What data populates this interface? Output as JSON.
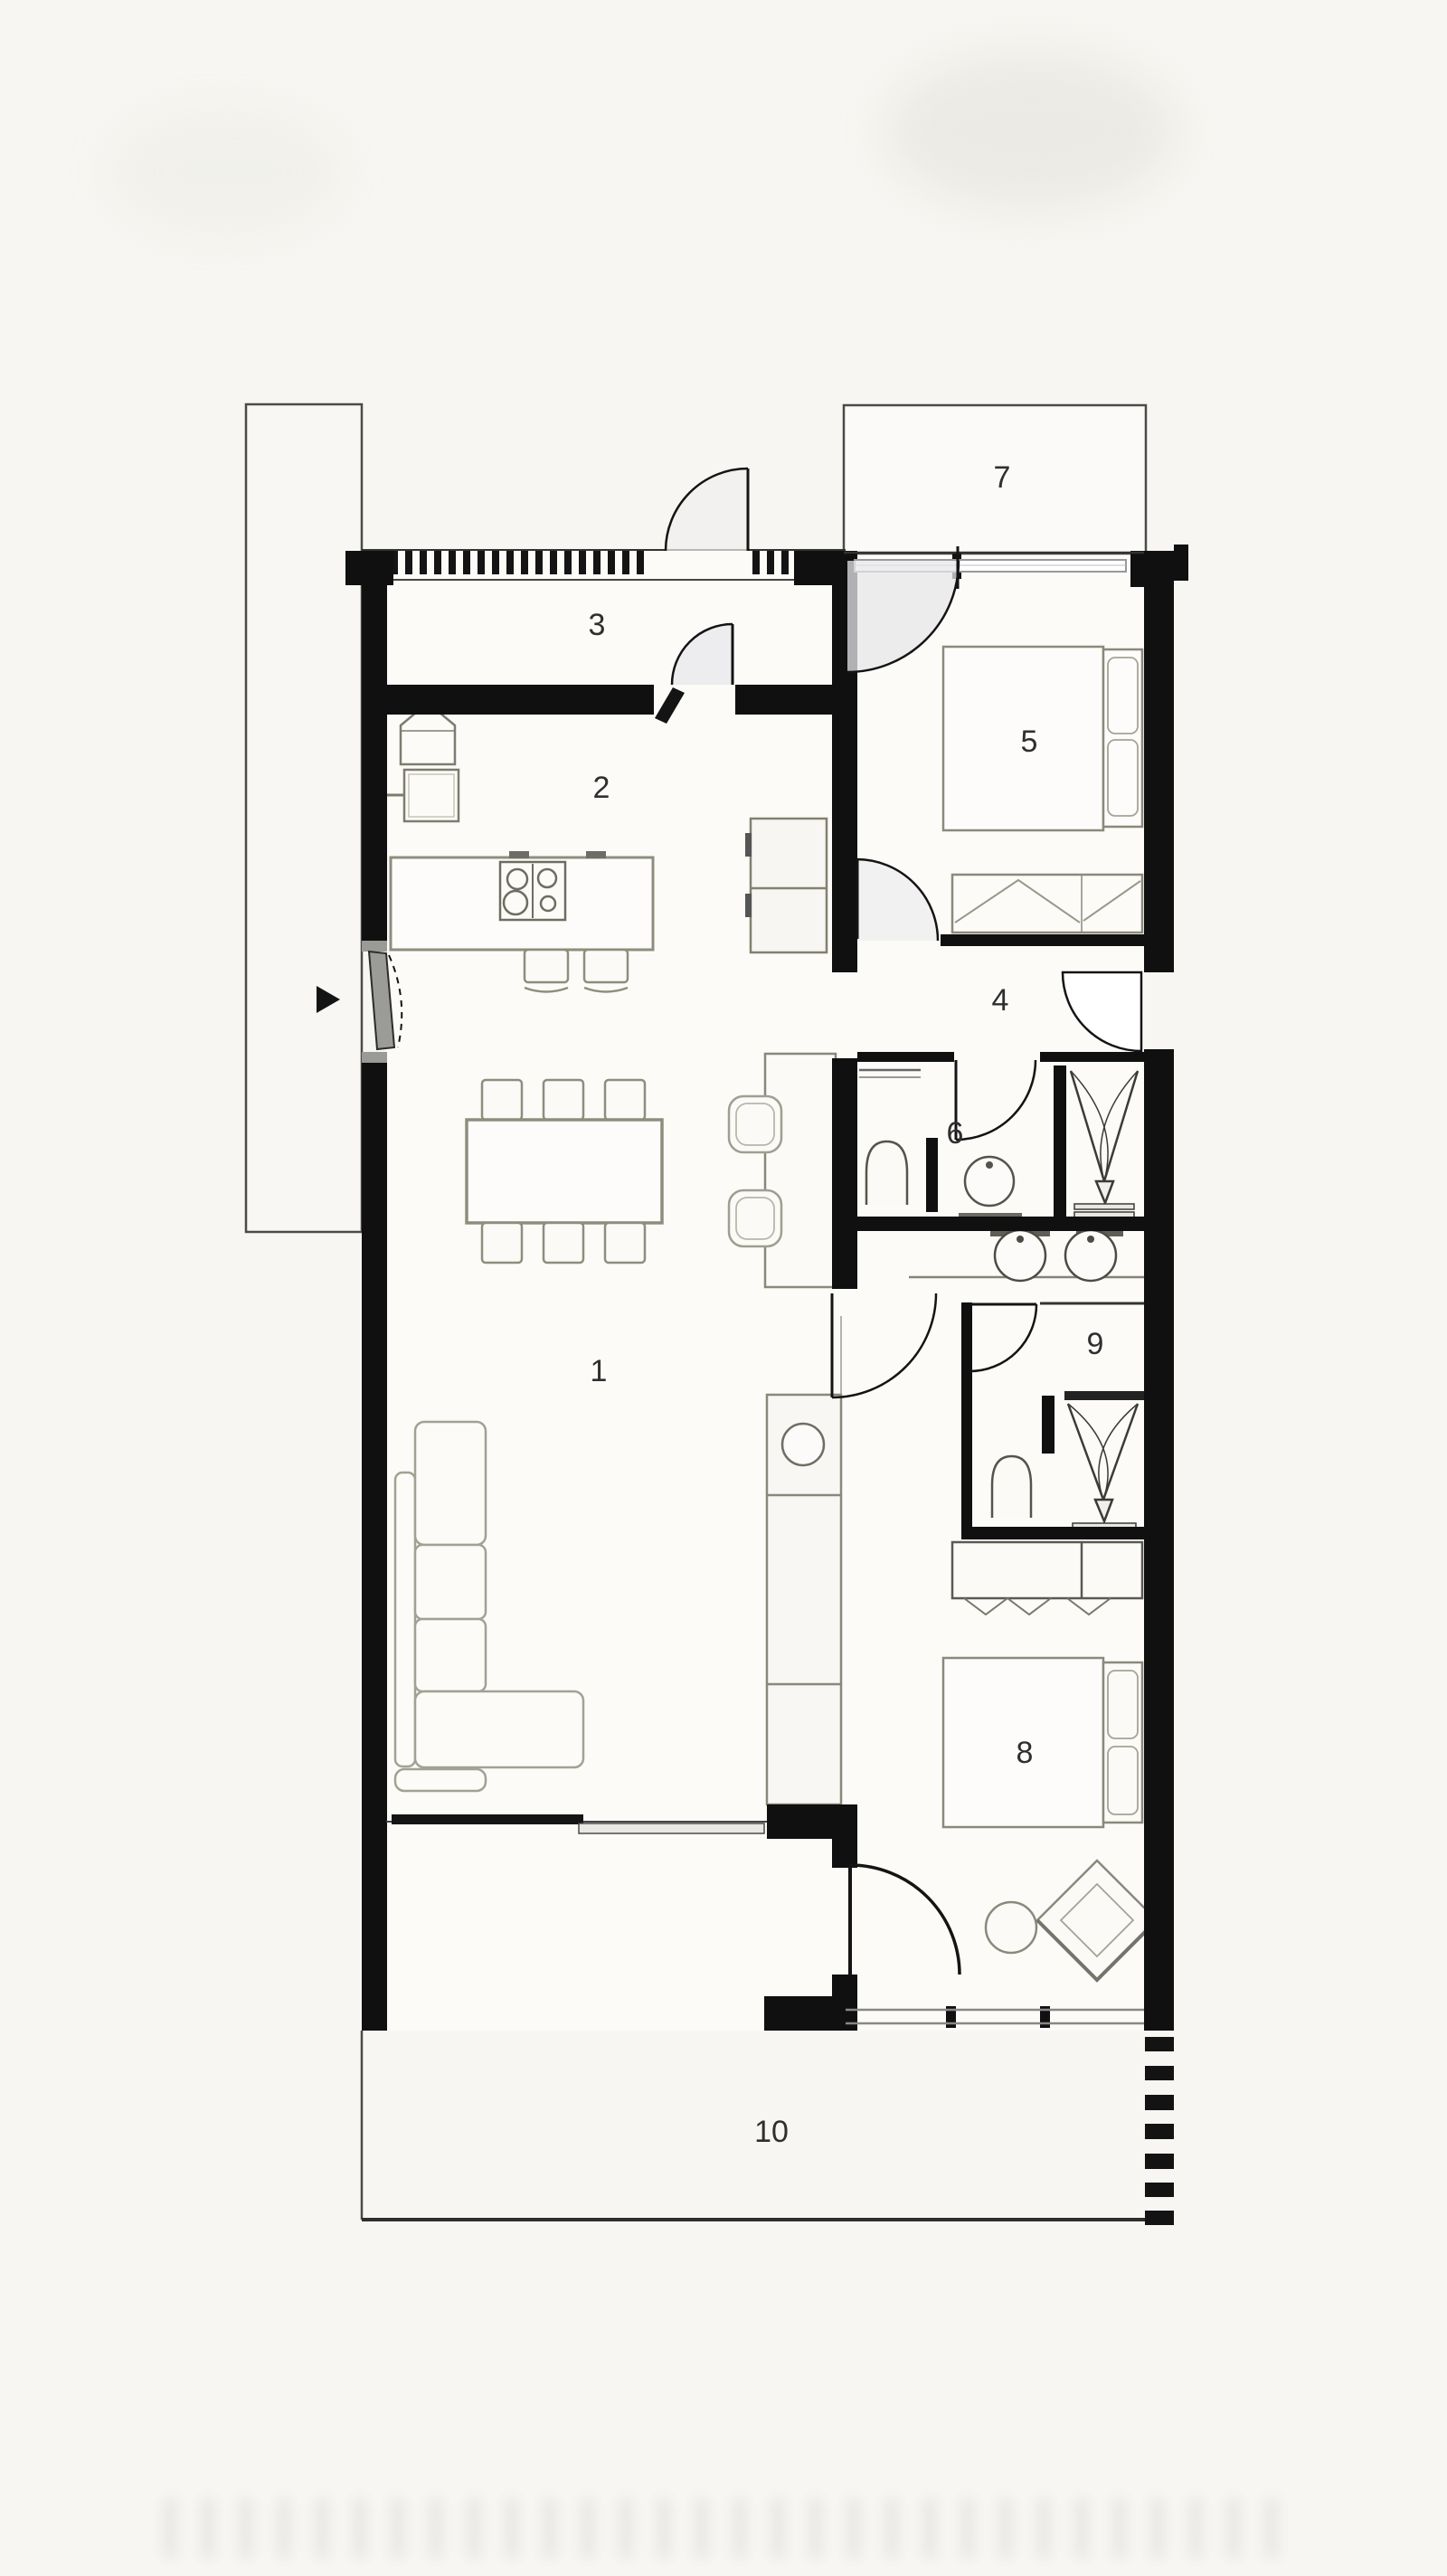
{
  "drawing": {
    "type": "floor-plan",
    "room_labels": [
      "1",
      "2",
      "3",
      "4",
      "5",
      "6",
      "7",
      "8",
      "9",
      "10"
    ]
  },
  "palette": {
    "wall": "#101010",
    "furniture_line": "#8f8d7d",
    "fixture_line": "#4c4b44",
    "paper": "#f7f6f2",
    "room_fill": "#fcfbf8",
    "label_color": "#2f2f2f"
  }
}
